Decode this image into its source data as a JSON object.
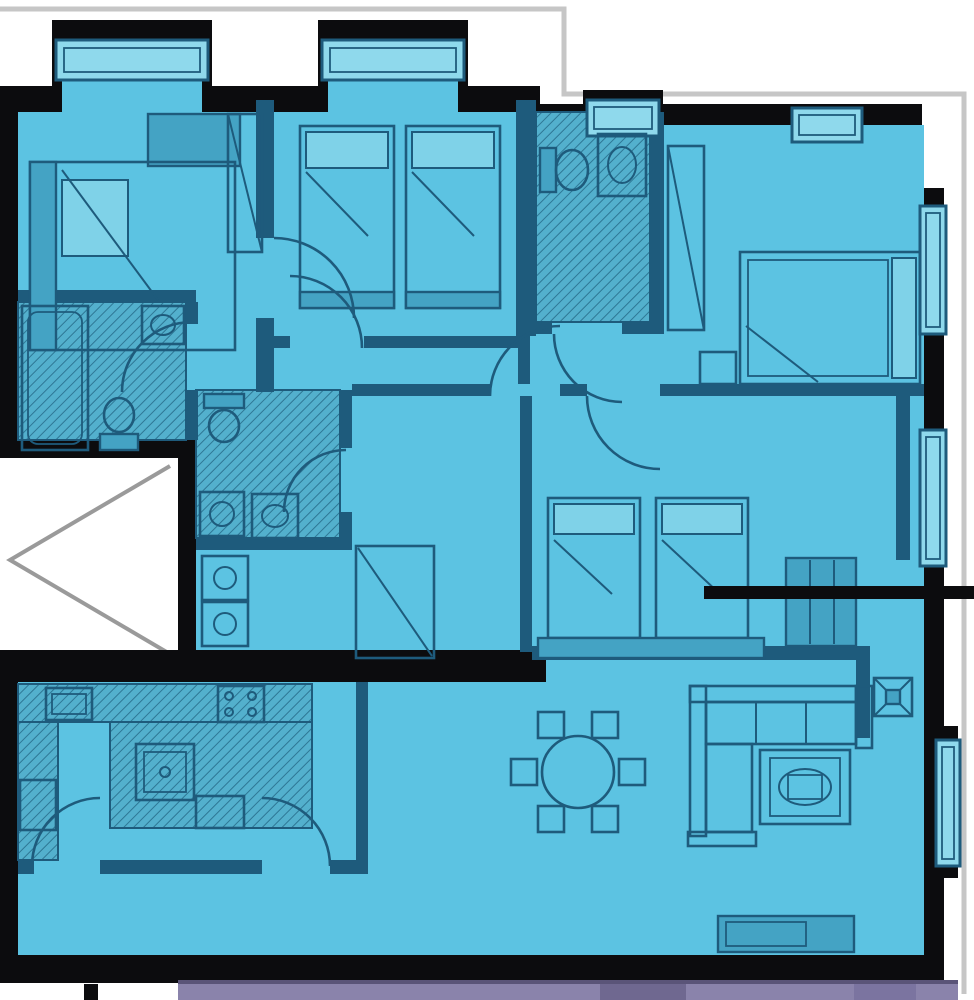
{
  "document": {
    "kind": "apartment-floor-plan",
    "visible_text": "",
    "notes": "blueprint-style plan, blue fill, thick black exterior walls, leader line pointing to twin bedroom, neighbor unit strip at bottom, lift shaft notch on left"
  },
  "palette": {
    "wall": "#0c0c0e",
    "floor": "#5cc3e2",
    "line": "#1e5b7c",
    "furn": "#44a3c4",
    "pillow": "#7fd2e8",
    "window": "#8fd9ec",
    "wet_floor": "#53b0cd",
    "hatch_line": "#2e7795",
    "outline": "#c6c6c6",
    "chevron": "#9a9a9a",
    "neighbor": "#8a83ab",
    "neighbor_dark": "#6f6890",
    "neighbor_light": "#7b74a0",
    "neighbor_line": "#5a5478",
    "outside": "#ffffff"
  },
  "plan": {
    "rooms": [
      {
        "name": "bedroom-top-left",
        "furniture": [
          "double-bed",
          "wardrobe",
          "dresser"
        ],
        "windows": 1
      },
      {
        "name": "bedroom-top-middle",
        "furniture": [
          "twin-bed",
          "twin-bed"
        ],
        "windows": 1
      },
      {
        "name": "bathroom-top-center",
        "furniture": [
          "toilet",
          "sink"
        ],
        "windows": 1
      },
      {
        "name": "bedroom-top-right",
        "furniture": [
          "double-bed",
          "wardrobe",
          "nightstand"
        ],
        "windows": 2
      },
      {
        "name": "bathroom-left",
        "furniture": [
          "bathtub",
          "toilet",
          "sink"
        ],
        "windows": 0
      },
      {
        "name": "bathroom-center",
        "furniture": [
          "toilet",
          "washer",
          "sink"
        ],
        "windows": 0
      },
      {
        "name": "bedroom-center-twin",
        "furniture": [
          "twin-bed",
          "twin-bed",
          "bench",
          "dresser"
        ],
        "windows": 1
      },
      {
        "name": "kitchen",
        "furniture": [
          "counter",
          "island",
          "kitchen-sink",
          "hob",
          "oven",
          "fridge"
        ],
        "windows": 0
      },
      {
        "name": "living-dining",
        "furniture": [
          "round-dining-table",
          "six-chairs",
          "corner-sofa",
          "rug",
          "tv-console",
          "plant-table"
        ],
        "windows": 1
      }
    ],
    "features": [
      "lift-shaft-chevron",
      "annotation-leader-line",
      "neighbor-unit-strip",
      "site-outline-gray"
    ]
  }
}
